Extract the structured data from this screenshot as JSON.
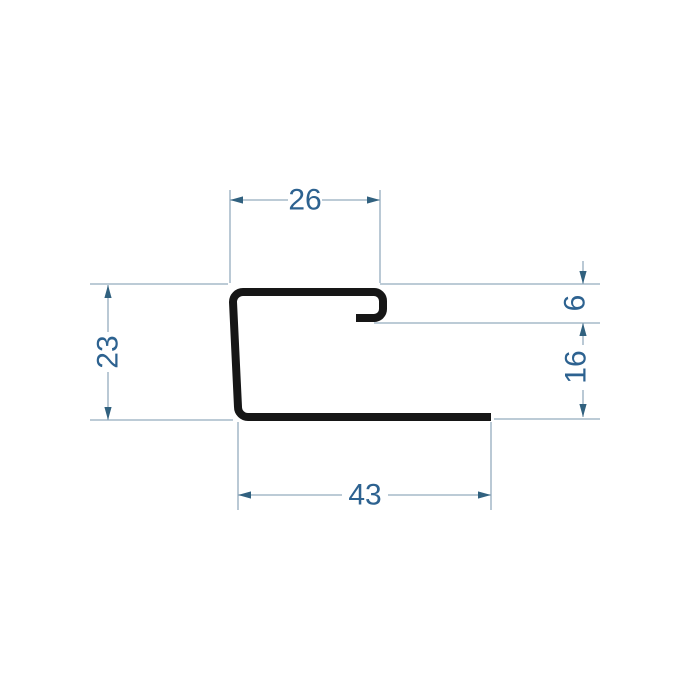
{
  "drawing": {
    "description": "Technical cross-section drawing of a J-channel metal edge profile with dimension annotations",
    "units_shown": false,
    "colors": {
      "background": "#ffffff",
      "profile_stroke": "#161616",
      "dimension_line": "#94acbe",
      "arrow": "#31617f",
      "dimension_text": "#2d6290"
    },
    "dimensions": {
      "top_width": "26",
      "left_height": "23",
      "right_hook_depth": "6",
      "right_lower_height": "16",
      "bottom_width": "43"
    }
  }
}
